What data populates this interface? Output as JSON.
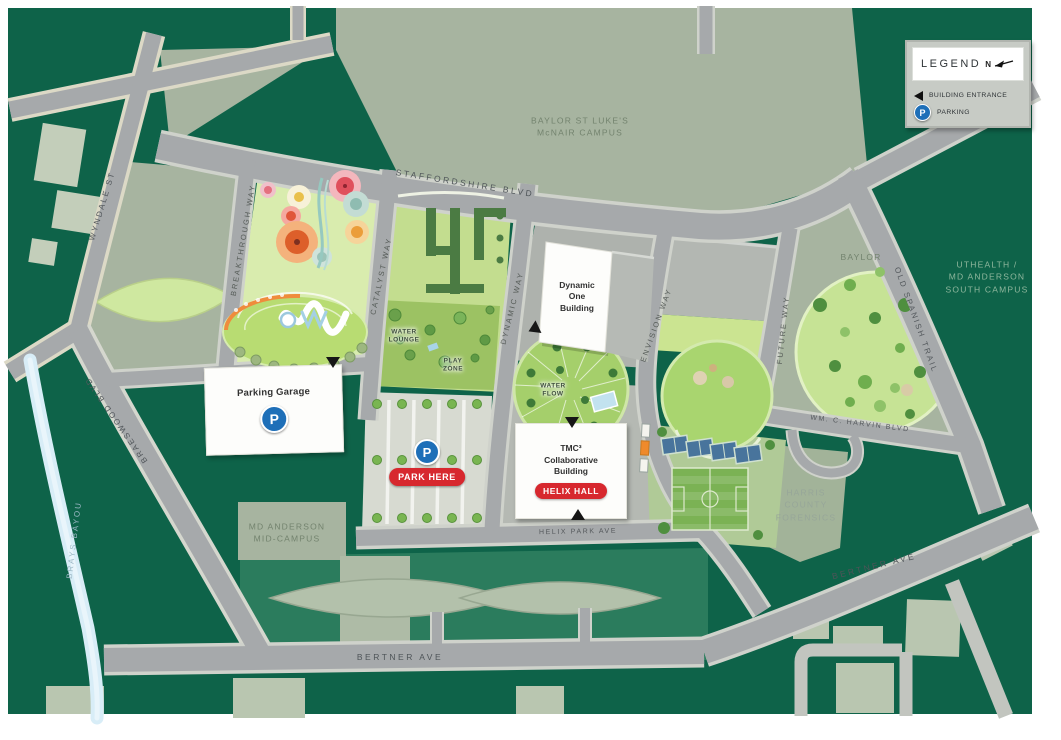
{
  "legend": {
    "title": "LEGEND",
    "north": "N",
    "entries": [
      {
        "icon": "entrance-arrow-icon",
        "label": "BUILDING ENTRANCE"
      },
      {
        "icon": "parking-icon",
        "label": "PARKING"
      }
    ]
  },
  "roads": {
    "staffordshire": "STAFFORDSHIRE BLVD",
    "wyndale": "WYNDALE ST",
    "braeswood": "BRAESWOOD BLVD",
    "bertner_south": "BERTNER AVE",
    "bertner_east": "BERTNER AVE",
    "old_spanish_trail": "OLD SPANISH TRAIL",
    "helix_park_ave": "HELIX PARK AVE",
    "harvin": "WM. C. HARVIN BLVD",
    "breakthrough_way": "BREAKTHROUGH WAY",
    "catalyst_way": "CATALYST WAY",
    "dynamic_way": "DYNAMIC WAY",
    "envision_way": "ENVISION WAY",
    "future_way": "FUTURE WAY"
  },
  "water": {
    "brays_bayou": "BRAYS BAYOU"
  },
  "areas": {
    "baylor_st_lukes": {
      "line1": "BAYLOR ST LUKE'S",
      "line2": "McNAIR CAMPUS"
    },
    "uthealth": {
      "line1": "UTHEALTH /",
      "line2": "MD ANDERSON",
      "line3": "SOUTH CAMPUS"
    },
    "md_anderson_mid": {
      "line1": "MD ANDERSON",
      "line2": "MID-CAMPUS"
    },
    "harris_forensics": {
      "line1": "HARRIS",
      "line2": "COUNTY",
      "line3": "FORENSICS"
    },
    "baylor": "BAYLOR"
  },
  "buildings": {
    "parking_garage": {
      "name": "Parking Garage"
    },
    "dynamic_one": {
      "line1": "Dynamic",
      "line2": "One",
      "line3": "Building"
    },
    "tmc3": {
      "line1": "TMC³",
      "line2": "Collaborative",
      "line3": "Building",
      "badge": "HELIX HALL"
    }
  },
  "markers": {
    "park_here": "PARK HERE",
    "parking_symbol": "P"
  },
  "park_features": {
    "water_lounge": {
      "line1": "WATER",
      "line2": "LOUNGE"
    },
    "play_zone": {
      "line1": "PLAY",
      "line2": "ZONE"
    },
    "water_flow": {
      "line1": "WATER",
      "line2": "FLOW"
    }
  },
  "colors": {
    "map_green": "#0e6349",
    "sage": "#a7b4a0",
    "road_gray": "#a6a9ab",
    "badge_red": "#d7282e",
    "parking_blue": "#1e6fb8",
    "bayou_blue": "#d7ecf6",
    "lawn_green": "#c8e491"
  }
}
